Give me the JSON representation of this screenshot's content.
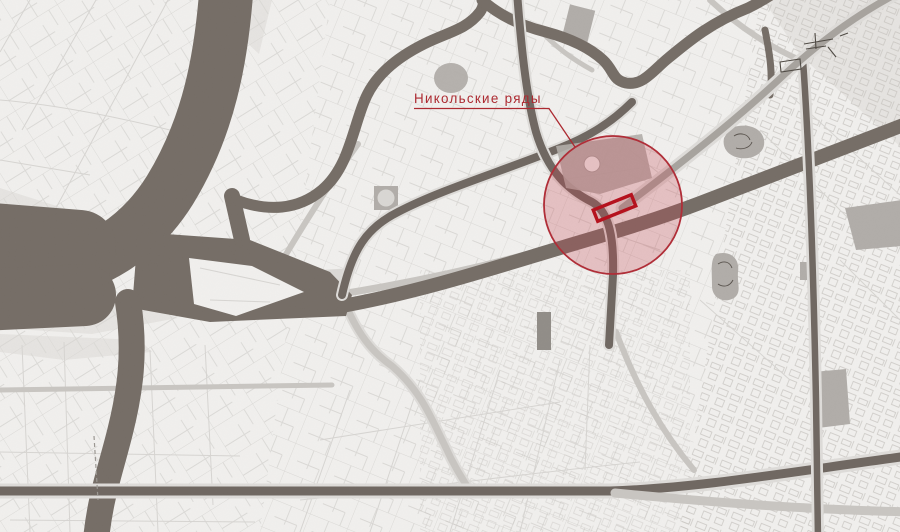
{
  "map": {
    "annotation": {
      "label": "Никольские ряды"
    },
    "colors": {
      "background": "#f1f0ee",
      "water": "#756d66",
      "road_dark": "#6f6761",
      "road_light": "#c9c6c2",
      "street": "#d7d5d2",
      "block_gray": "#b1ada9",
      "accent": "#ac2a31",
      "marker_red": "#b5121e",
      "highlight_stroke": "#b02e38",
      "highlight_fill": "rgba(197,66,77,0.27)"
    }
  }
}
